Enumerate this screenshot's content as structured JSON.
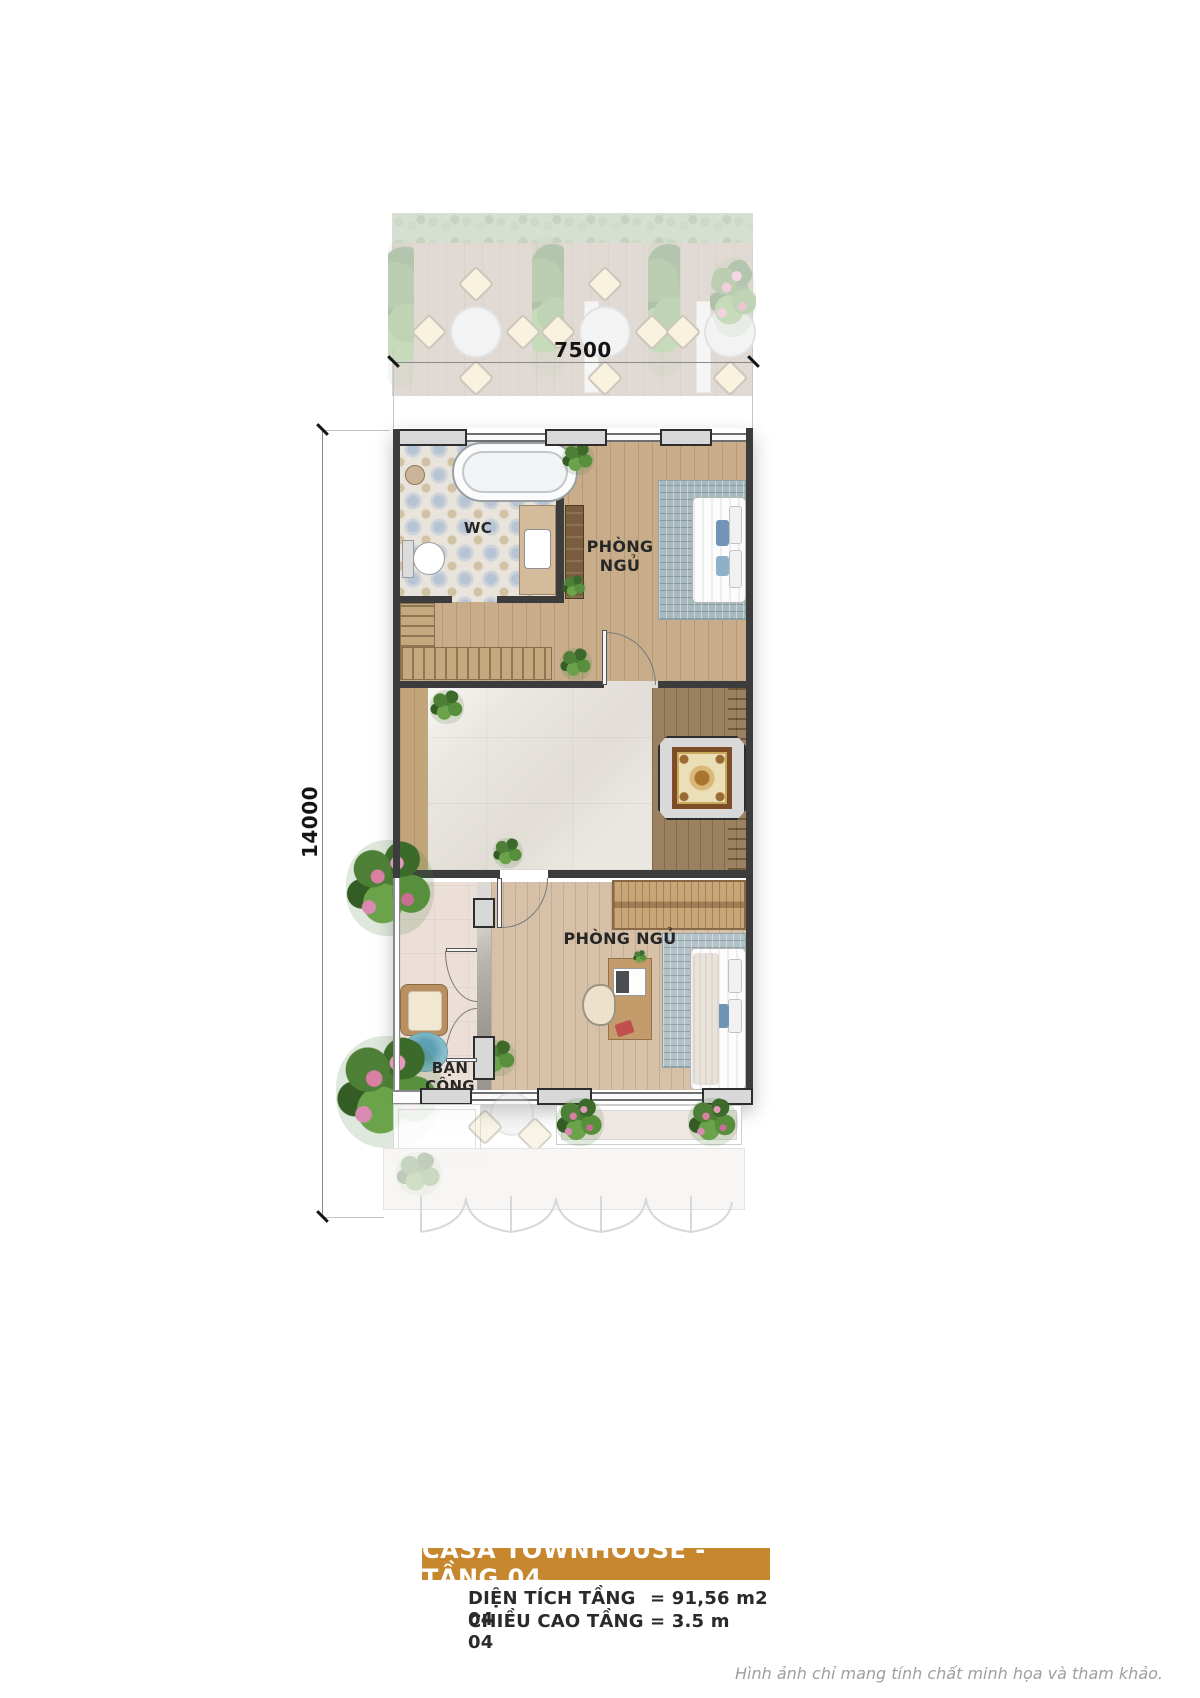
{
  "colors": {
    "accent": "#c6872e",
    "wall": "#3c3c3c"
  },
  "dimensions": {
    "width_label": "7500",
    "height_label": "14000"
  },
  "rooms": {
    "wc": "WC",
    "bedroom_top_line1": "PHÒNG",
    "bedroom_top_line2": "NGỦ",
    "bedroom_bottom": "PHÒNG NGỦ",
    "balcony_line1": "BẠN",
    "balcony_line2": "CÔNG"
  },
  "title_block": {
    "title": "CASA TOWNHOUSE - TẦNG 04",
    "rows": [
      {
        "label": "DIỆN TÍCH TẦNG 04",
        "value": "= 91,56 m2"
      },
      {
        "label": "CHIỀU CAO TẦNG 04",
        "value": "= 3.5 m"
      }
    ]
  },
  "disclaimer": "Hình ảnh chỉ mang tính chất minh họa và tham khảo."
}
